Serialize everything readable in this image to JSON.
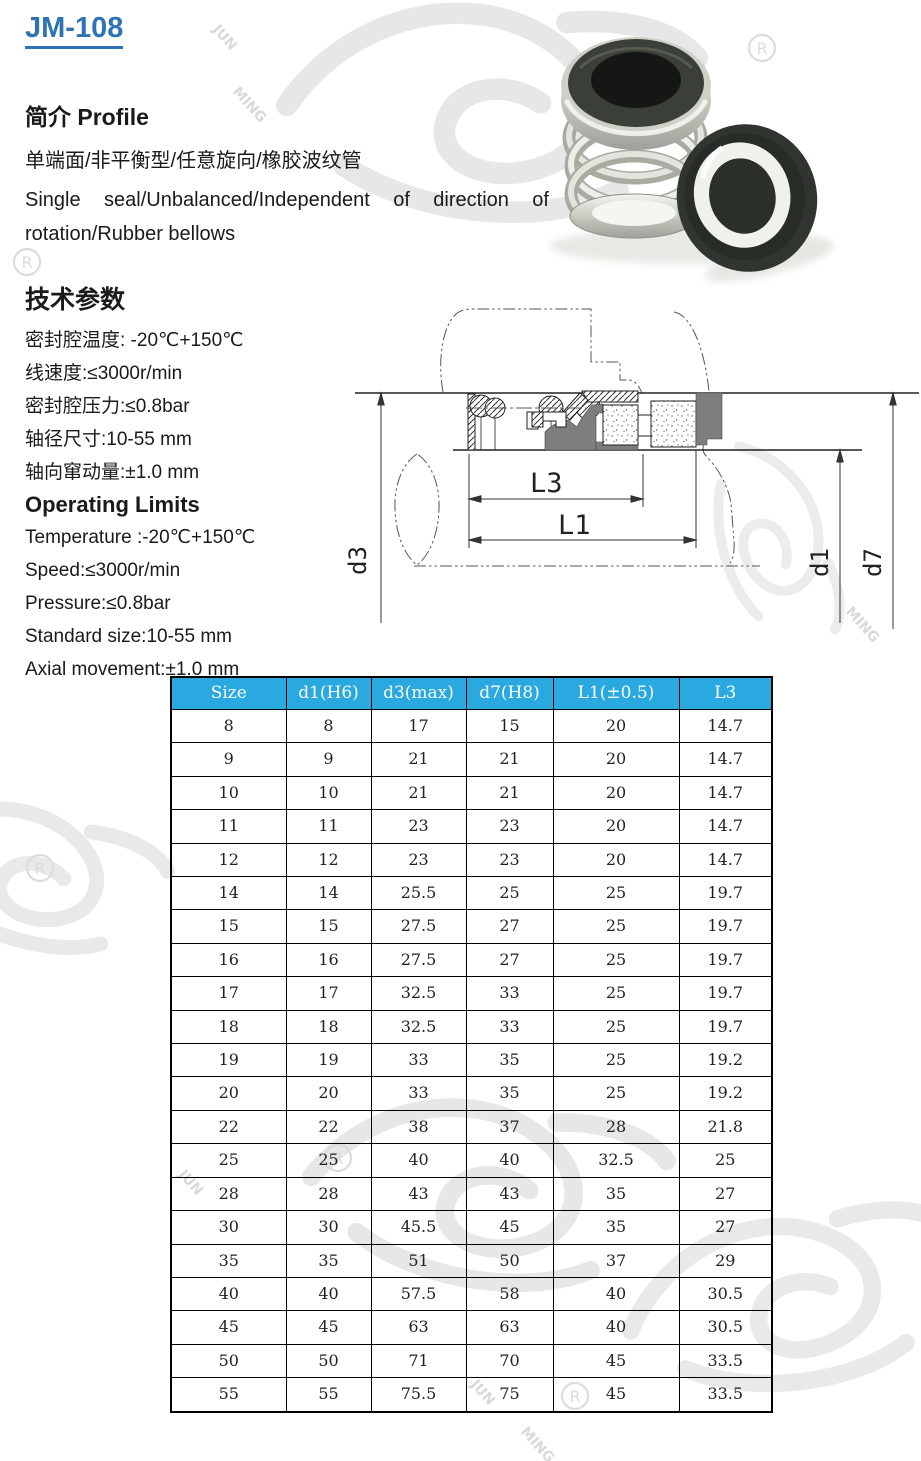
{
  "page": {
    "title": "JM-108"
  },
  "profile": {
    "heading": "简介  Profile",
    "line_zh": "单端面/非平衡型/任意旋向/橡胶波纹管",
    "line_en": "Single seal/Unbalanced/Independent of direction of rotation/Rubber bellows"
  },
  "tech_params": {
    "heading": "技术参数",
    "lines": [
      "密封腔温度: -20℃+150℃",
      "线速度:≤3000r/min",
      "密封腔压力:≤0.8bar",
      "轴径尺寸:10-55 mm",
      "轴向窜动量:±1.0 mm"
    ]
  },
  "operating_limits": {
    "heading": "Operating Limits",
    "lines": [
      "Temperature :-20℃+150℃",
      "Speed:≤3000r/min",
      "Pressure:≤0.8bar",
      "Standard size:10-55 mm",
      "Axial movement:±1.0 mm"
    ]
  },
  "diagram": {
    "labels": {
      "l3": "L3",
      "l1": "L1",
      "d3": "d3",
      "d1": "d1",
      "d7": "d7"
    }
  },
  "table": {
    "header_bg": "#29a9e0",
    "headers": [
      "Size",
      "d1(H6)",
      "d3(max)",
      "d7(H8)",
      "L1(±0.5)",
      "L3"
    ],
    "rows": [
      [
        "8",
        "8",
        "17",
        "15",
        "20",
        "14.7"
      ],
      [
        "9",
        "9",
        "21",
        "21",
        "20",
        "14.7"
      ],
      [
        "10",
        "10",
        "21",
        "21",
        "20",
        "14.7"
      ],
      [
        "11",
        "11",
        "23",
        "23",
        "20",
        "14.7"
      ],
      [
        "12",
        "12",
        "23",
        "23",
        "20",
        "14.7"
      ],
      [
        "14",
        "14",
        "25.5",
        "25",
        "25",
        "19.7"
      ],
      [
        "15",
        "15",
        "27.5",
        "27",
        "25",
        "19.7"
      ],
      [
        "16",
        "16",
        "27.5",
        "27",
        "25",
        "19.7"
      ],
      [
        "17",
        "17",
        "32.5",
        "33",
        "25",
        "19.7"
      ],
      [
        "18",
        "18",
        "32.5",
        "33",
        "25",
        "19.7"
      ],
      [
        "19",
        "19",
        "33",
        "35",
        "25",
        "19.2"
      ],
      [
        "20",
        "20",
        "33",
        "35",
        "25",
        "19.2"
      ],
      [
        "22",
        "22",
        "38",
        "37",
        "28",
        "21.8"
      ],
      [
        "25",
        "25",
        "40",
        "40",
        "32.5",
        "25"
      ],
      [
        "28",
        "28",
        "43",
        "43",
        "35",
        "27"
      ],
      [
        "30",
        "30",
        "45.5",
        "45",
        "35",
        "27"
      ],
      [
        "35",
        "35",
        "51",
        "50",
        "37",
        "29"
      ],
      [
        "40",
        "40",
        "57.5",
        "58",
        "40",
        "30.5"
      ],
      [
        "45",
        "45",
        "63",
        "63",
        "40",
        "30.5"
      ],
      [
        "50",
        "50",
        "71",
        "70",
        "45",
        "33.5"
      ],
      [
        "55",
        "55",
        "75.5",
        "75",
        "45",
        "33.5"
      ]
    ]
  },
  "watermark": {
    "jun": "JUN",
    "ming": "MING",
    "reg": "R"
  }
}
